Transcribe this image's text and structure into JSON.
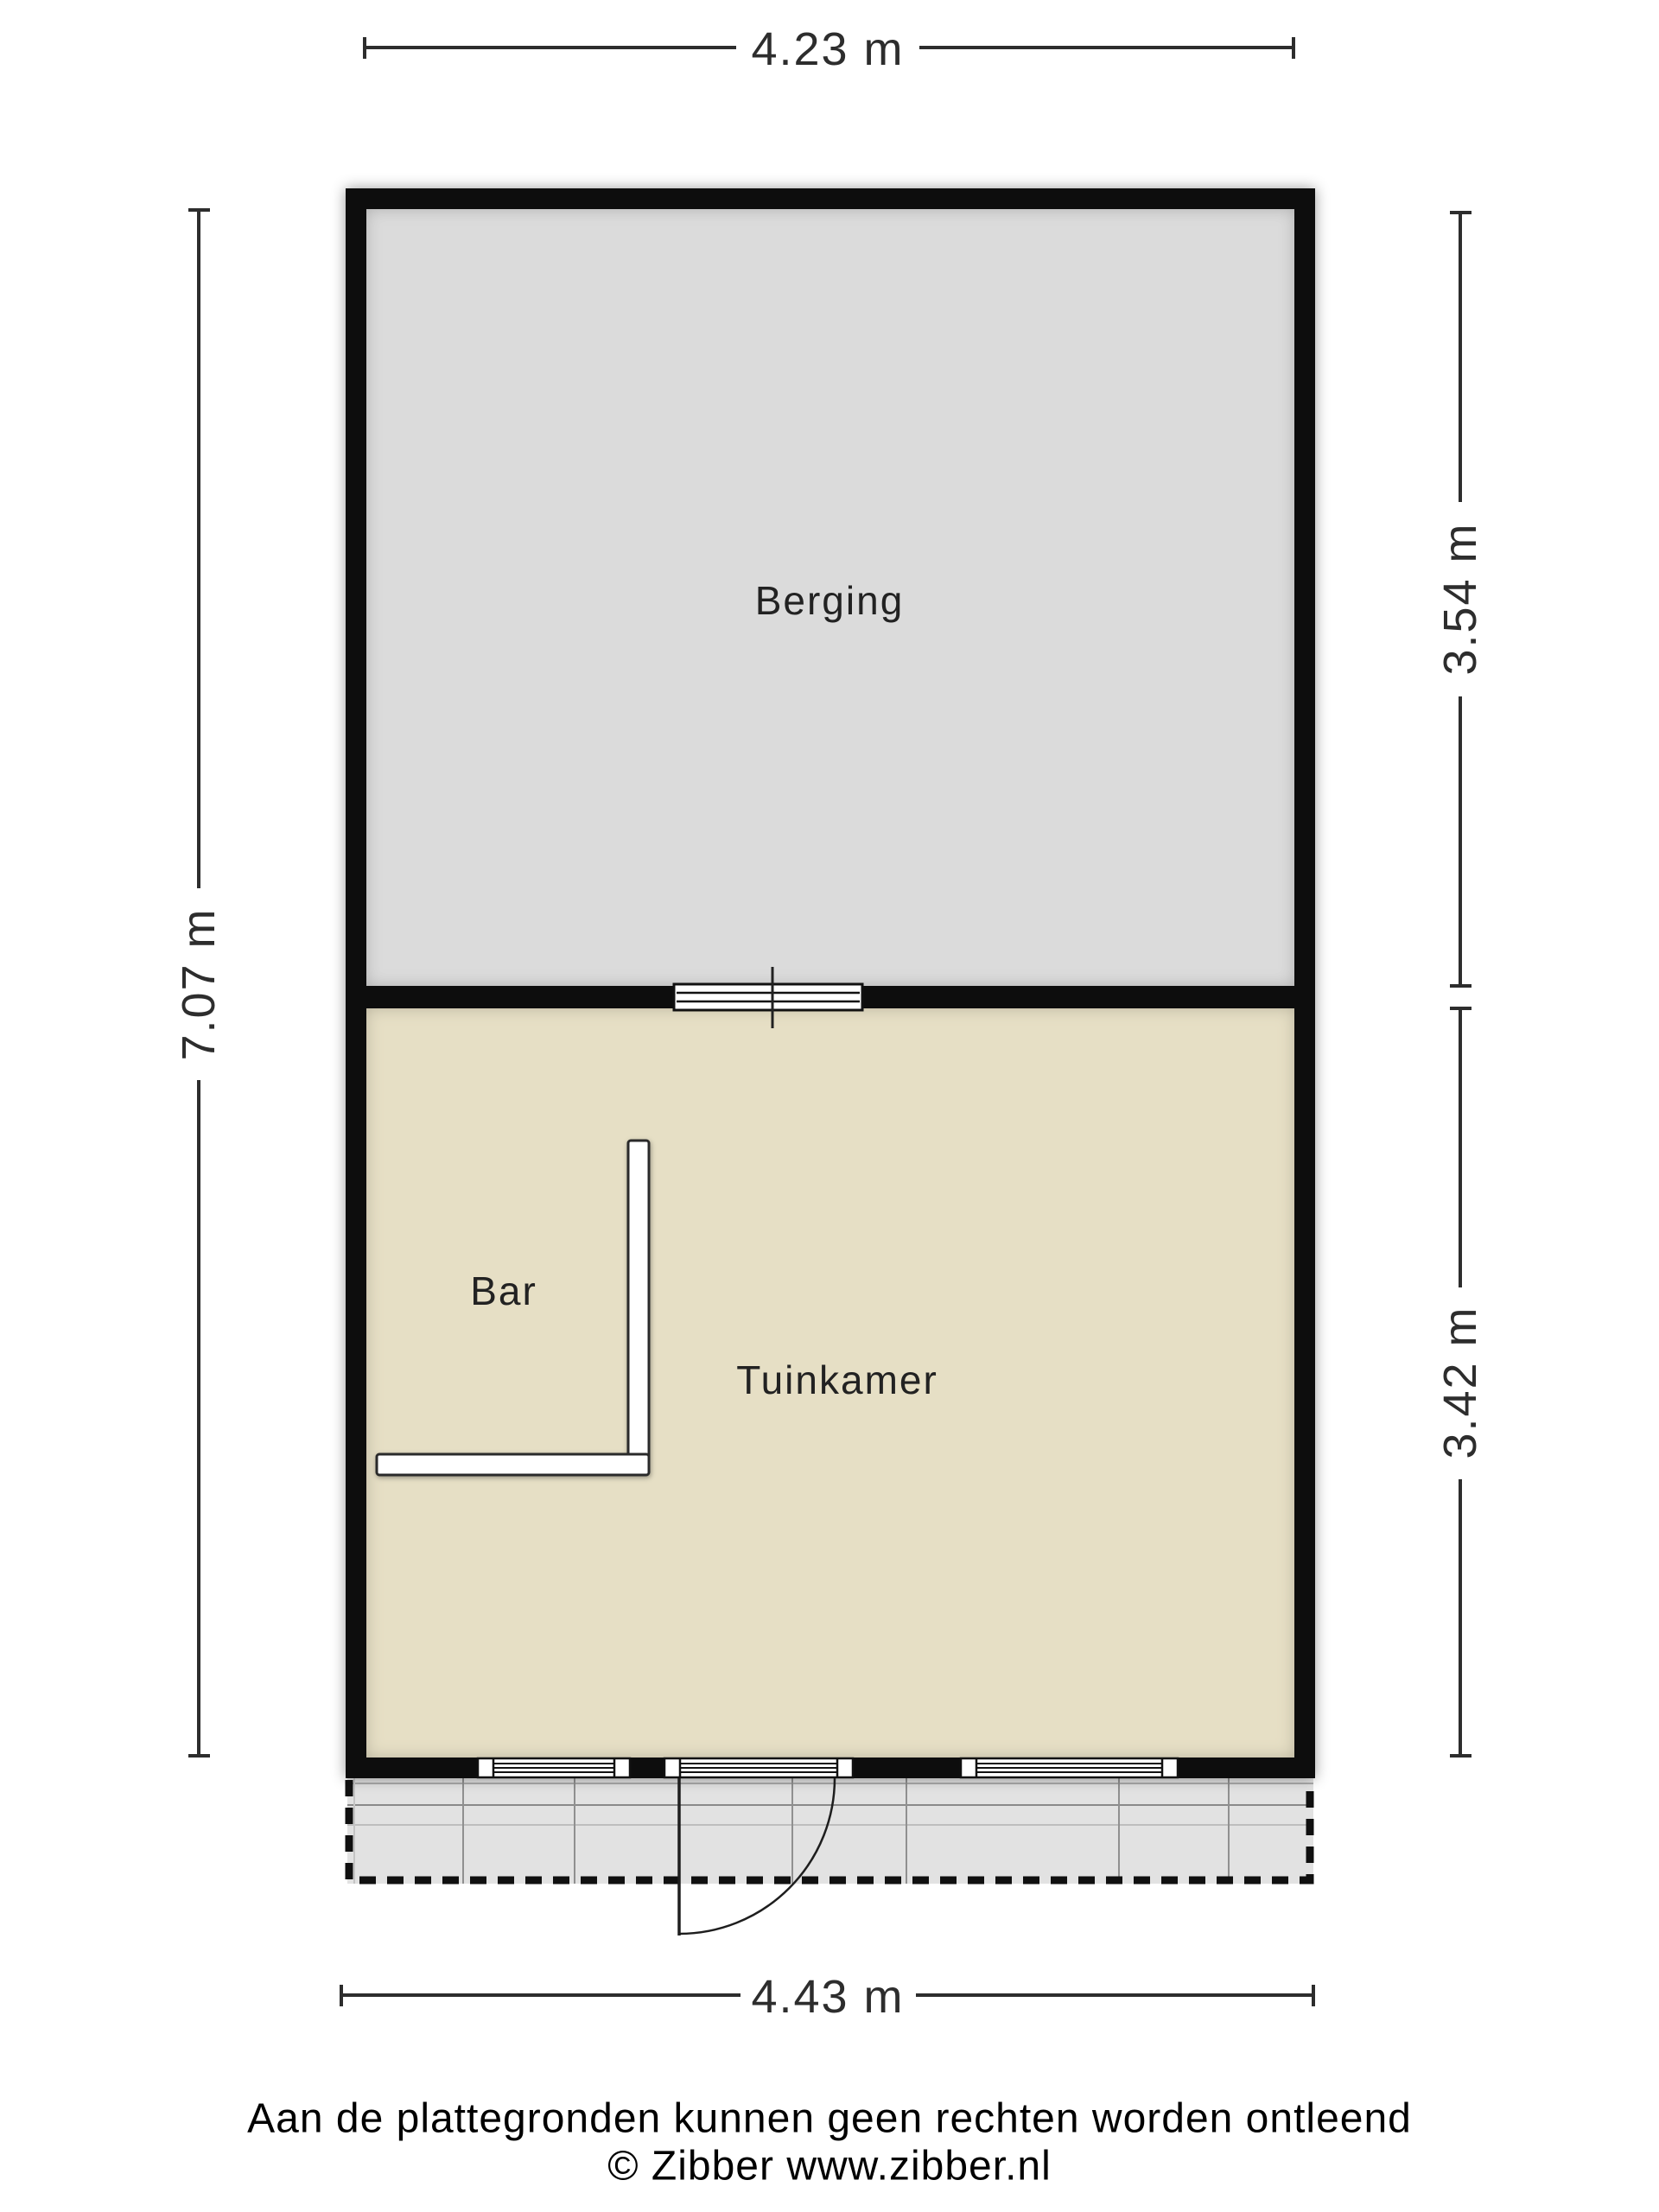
{
  "plan": {
    "rooms": {
      "berging": {
        "label": "Berging"
      },
      "tuinkamer": {
        "label": "Tuinkamer"
      },
      "bar": {
        "label": "Bar"
      }
    },
    "dimensions": {
      "top": "4.23 m",
      "bottom": "4.43 m",
      "left": "7.07 m",
      "right_upper": "3.54 m",
      "right_lower": "3.42 m"
    }
  },
  "footer": {
    "disclaimer": "Aan de plattegronden kunnen geen rechten worden ontleend",
    "copyright": "© Zibber www.zibber.nl"
  },
  "colors": {
    "wall": "#070707",
    "berging_floor": "#dbdbdb",
    "tuinkamer_floor": "#e6dfc5",
    "terrace": "#e2e2e2",
    "dimension": "#2d2d2d",
    "room_label": "#222222"
  }
}
